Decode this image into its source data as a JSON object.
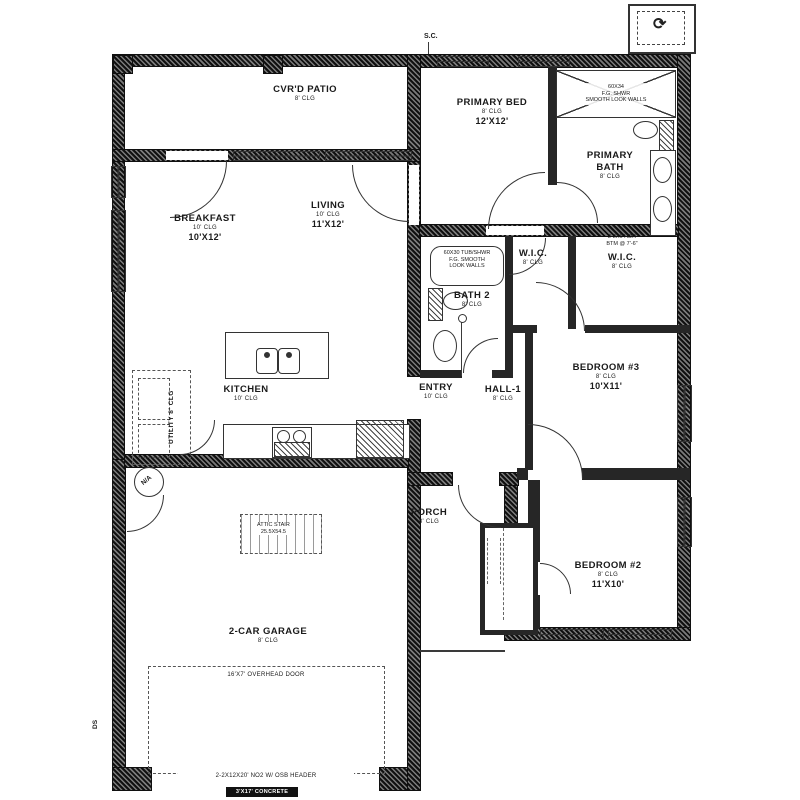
{
  "colors": {
    "ink": "#1a1a1a",
    "wall_dark": "#101010",
    "wall_light": "#7a7a7a",
    "bg": "#ffffff"
  },
  "rooms": {
    "patio": {
      "name": "CVR'D PATIO",
      "clg": "8' CLG"
    },
    "breakfast": {
      "name": "BREAKFAST",
      "clg": "10' CLG",
      "dims": "10'X12'"
    },
    "living": {
      "name": "LIVING",
      "clg": "10' CLG",
      "dims": "11'X12'"
    },
    "kitchen": {
      "name": "KITCHEN",
      "clg": "10' CLG"
    },
    "utility": {
      "name": "UTILITY  8' CLG"
    },
    "primary_bed": {
      "name": "PRIMARY BED",
      "clg": "8' CLG",
      "dims": "12'X12'"
    },
    "primary_bath": {
      "name": "PRIMARY BATH",
      "clg": "8' CLG"
    },
    "wic_primary": {
      "name": "W.I.C.",
      "clg": "8' CLG"
    },
    "wic_hall": {
      "name": "W.I.C.",
      "clg": "8' CLG"
    },
    "bath2": {
      "name": "BATH 2",
      "clg": "8' CLG"
    },
    "entry": {
      "name": "ENTRY",
      "clg": "10' CLG"
    },
    "hall1": {
      "name": "HALL-1",
      "clg": "8' CLG"
    },
    "bedroom3": {
      "name": "BEDROOM #3",
      "clg": "8' CLG",
      "dims": "10'X11'"
    },
    "bedroom2": {
      "name": "BEDROOM #2",
      "clg": "8' CLG",
      "dims": "11'X10'"
    },
    "porch": {
      "name": "PORCH",
      "clg": "8' CLG"
    },
    "garage": {
      "name": "2-CAR GARAGE",
      "clg": "8' CLG"
    }
  },
  "fixtures": {
    "primary_shower": {
      "l1": "60X34",
      "l2": "F.G. SHWR",
      "l3": "SMOOTH LOOK WALLS"
    },
    "bath2_tub": {
      "l1": "60X30 TUB/SHWR",
      "l2": "F.G. SMOOTH",
      "l3": "LOOK WALLS"
    },
    "attic_stair": {
      "l1": "ATTIC STAIR",
      "l2": "25.5X54.5"
    }
  },
  "notes": {
    "wic_header": {
      "l1": "2-2X6 HDR",
      "l2": "BTM @ 7'-6\""
    },
    "overhead_door": "16'X7' OVERHEAD DOOR",
    "osb_header": "2-2X12X20' NO2 W/ OSB HEADER",
    "concrete_apron": "3'X17' CONCRETE APRON"
  },
  "markers": {
    "sc": "S.C.",
    "na": "N/A",
    "ds": "DS",
    "flex_icon": "⟳"
  }
}
